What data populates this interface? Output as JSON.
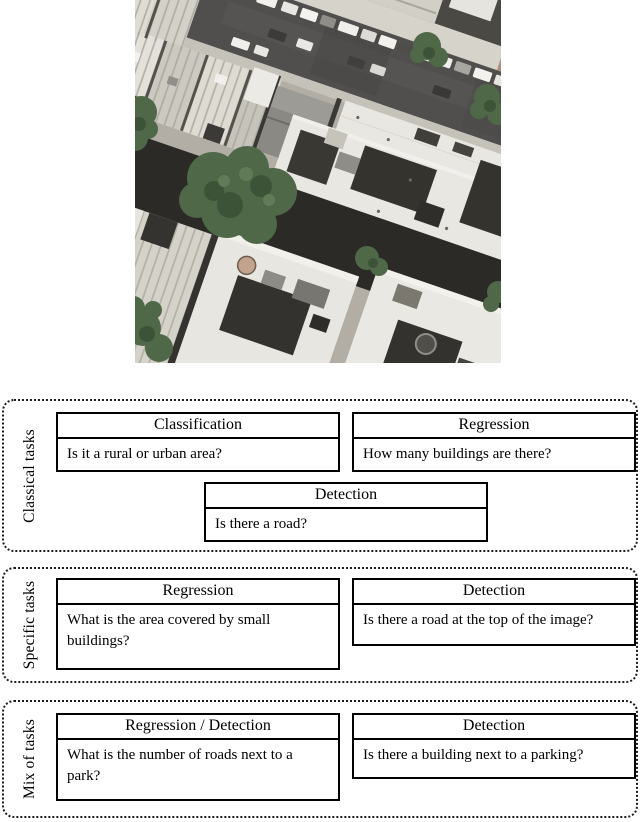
{
  "figure": {
    "aerial_image": {
      "alt": "Aerial orthophoto of a dense urban block: a diagonal street with parked cars at the top, large white-roofed buildings with dark tar roof sections, rowhouses, tree canopies and shadowed courtyards",
      "palette": {
        "road": "#504f4d",
        "sidewalk": "#d6d3cb",
        "roof_light": "#e9e7e2",
        "roof_dark": "#34332e",
        "rowhouse": "#d8d5cd",
        "tree": "#4f6847",
        "ground_shadow": "#2b2a27",
        "dirt_patch": "#b28f7d"
      }
    },
    "groups": [
      {
        "label": "Classical tasks",
        "rows": [
          {
            "boxes": [
              {
                "header": "Classification",
                "question": "Is it a rural or urban area?"
              },
              {
                "header": "Regression",
                "question": "How many buildings are there?"
              }
            ]
          },
          {
            "boxes": [
              {
                "header": "Detection",
                "question": "Is there a road?"
              }
            ]
          }
        ]
      },
      {
        "label": "Specific tasks",
        "rows": [
          {
            "boxes": [
              {
                "header": "Regression",
                "question": "What is the area covered by small buildings?"
              },
              {
                "header": "Detection",
                "question": "Is there a road at the top of the image?"
              }
            ]
          }
        ]
      },
      {
        "label": "Mix of tasks",
        "rows": [
          {
            "boxes": [
              {
                "header": "Regression / Detection",
                "question": "What is the number of roads next to a park?"
              },
              {
                "header": "Detection",
                "question": "Is there a building next to a parking?"
              }
            ]
          }
        ]
      }
    ]
  }
}
